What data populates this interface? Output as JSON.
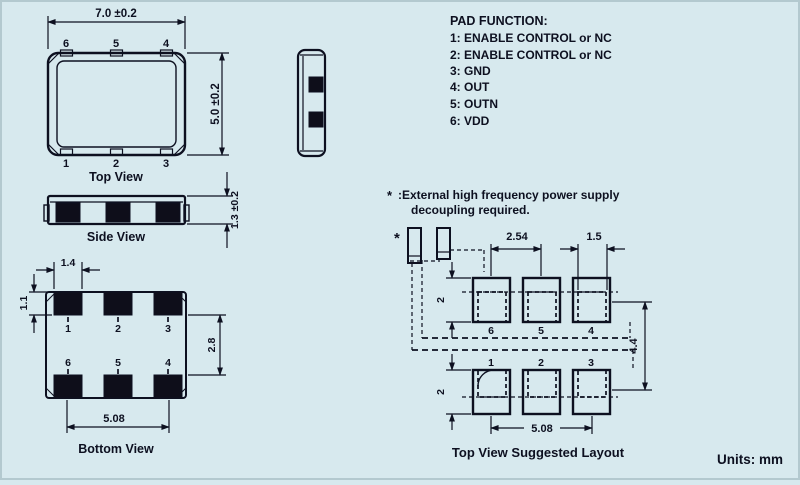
{
  "colors": {
    "background": "#d7e9ee",
    "ink": "#0d1020",
    "pad_fill": "#0e0e1a"
  },
  "pad_function": {
    "title": "PAD FUNCTION:",
    "items": [
      "1: ENABLE CONTROL or NC",
      "2: ENABLE CONTROL or NC",
      "3: GND",
      "4: OUT",
      "5: OUTN",
      "6: VDD"
    ]
  },
  "note": {
    "marker": "*",
    "line1": ":External high frequency power supply",
    "line2": "decoupling required."
  },
  "top_view": {
    "label": "Top View",
    "width_dim": "7.0 ±0.2",
    "height_dim": "5.0 ±0.2",
    "pins_top": [
      "6",
      "5",
      "4"
    ],
    "pins_bottom": [
      "1",
      "2",
      "3"
    ]
  },
  "side_view": {
    "label": "Side View",
    "thickness_dim": "1.3 ±0.2"
  },
  "bottom_view": {
    "label": "Bottom View",
    "pad_width_dim": "1.4",
    "pad_height_dim": "1.1",
    "row_gap_dim": "2.8",
    "span_dim": "5.08",
    "pins_row1": [
      "1",
      "2",
      "3"
    ],
    "pins_row2": [
      "6",
      "5",
      "4"
    ]
  },
  "layout": {
    "label": "Top View Suggested Layout",
    "star": "*",
    "pitch_dim": "2.54",
    "pad_width_dim": "1.5",
    "pad_height_top_dim": "2",
    "pad_height_bottom_dim": "2",
    "vertical_span_dim": "4.4",
    "horizontal_span_dim": "5.08",
    "pins_top": [
      "6",
      "5",
      "4"
    ],
    "pins_bottom": [
      "1",
      "2",
      "3"
    ]
  },
  "units_label": "Units: mm"
}
